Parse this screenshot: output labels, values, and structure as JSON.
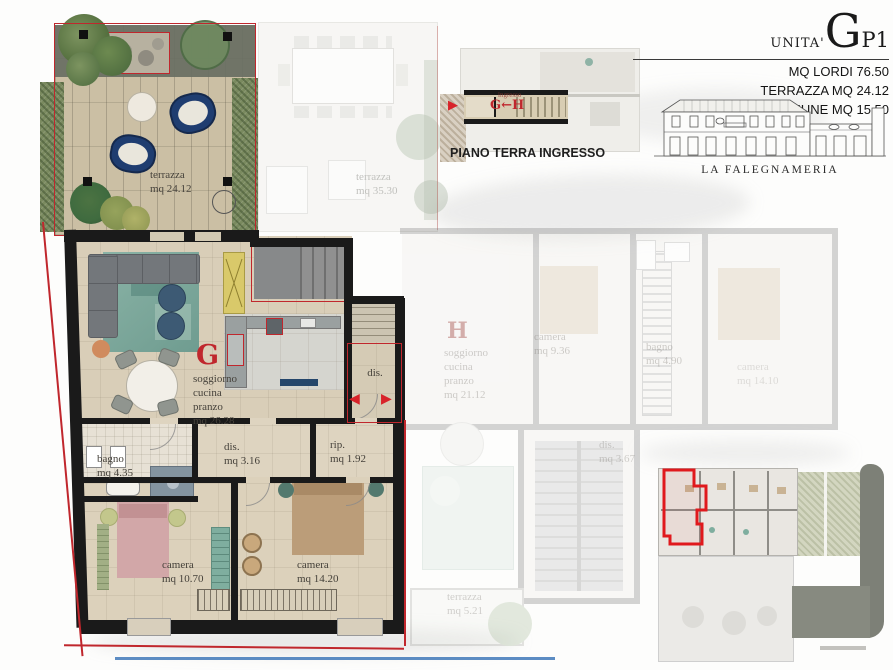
{
  "colors": {
    "accent_red": "#c0272d",
    "wall_black": "#1a1a1a",
    "terrace_tile": "#cbbfa4",
    "floor_beige": "#d9ceb8",
    "hedge_green": "#7a8a5f",
    "rug_teal": "#86b1a4",
    "chair_navy": "#1f3d70",
    "bed_pink": "#d2a7a8",
    "bed_tan": "#bb9d79",
    "cabinet_yellow": "#d9c96a",
    "railing_blue": "#3f78b8"
  },
  "header": {
    "unit_prefix": "UNITA'",
    "unit_letter": "G",
    "unit_suffix": "P1",
    "line1": "MQ LORDI 76.50",
    "line2": "TERRAZZA MQ 24.12",
    "line3": "INGRESSO COMUNE MQ 15.50"
  },
  "elevation": {
    "caption": "LA FALEGNAMERIA"
  },
  "inset": {
    "caption": "PIANO TERRA INGRESSO",
    "corridor_sublabel": "ingresso",
    "corridor_label": "G←H",
    "arrow": "▶"
  },
  "unit_g": {
    "letter": "G",
    "terrazza": "terrazza\nmq 24.12",
    "soggiorno": "soggiorno\ncucina\npranzo\nmq 26.28",
    "entry_dis": "dis.",
    "dis": "dis.\nmq 3.16",
    "rip": "rip.\nmq 1.92",
    "bagno": "bagno\nmq 4.35",
    "camera1": "camera\nmq 10.70",
    "camera2": "camera\nmq 14.20",
    "arrow_left": "◀",
    "arrow_right": "▶"
  },
  "unit_h": {
    "letter": "H",
    "terrazza": "terrazza\nmq 35.30",
    "soggiorno": "soggiorno\ncucina\npranzo\nmq 21.12",
    "camera1": "camera\nmq 9.36",
    "bagno": "bagno\nmq 4.90",
    "dis": "dis.\nmq 3.67",
    "camera2": "camera\nmq 14.10",
    "terrazza2": "terrazza\nmq 5.21"
  }
}
